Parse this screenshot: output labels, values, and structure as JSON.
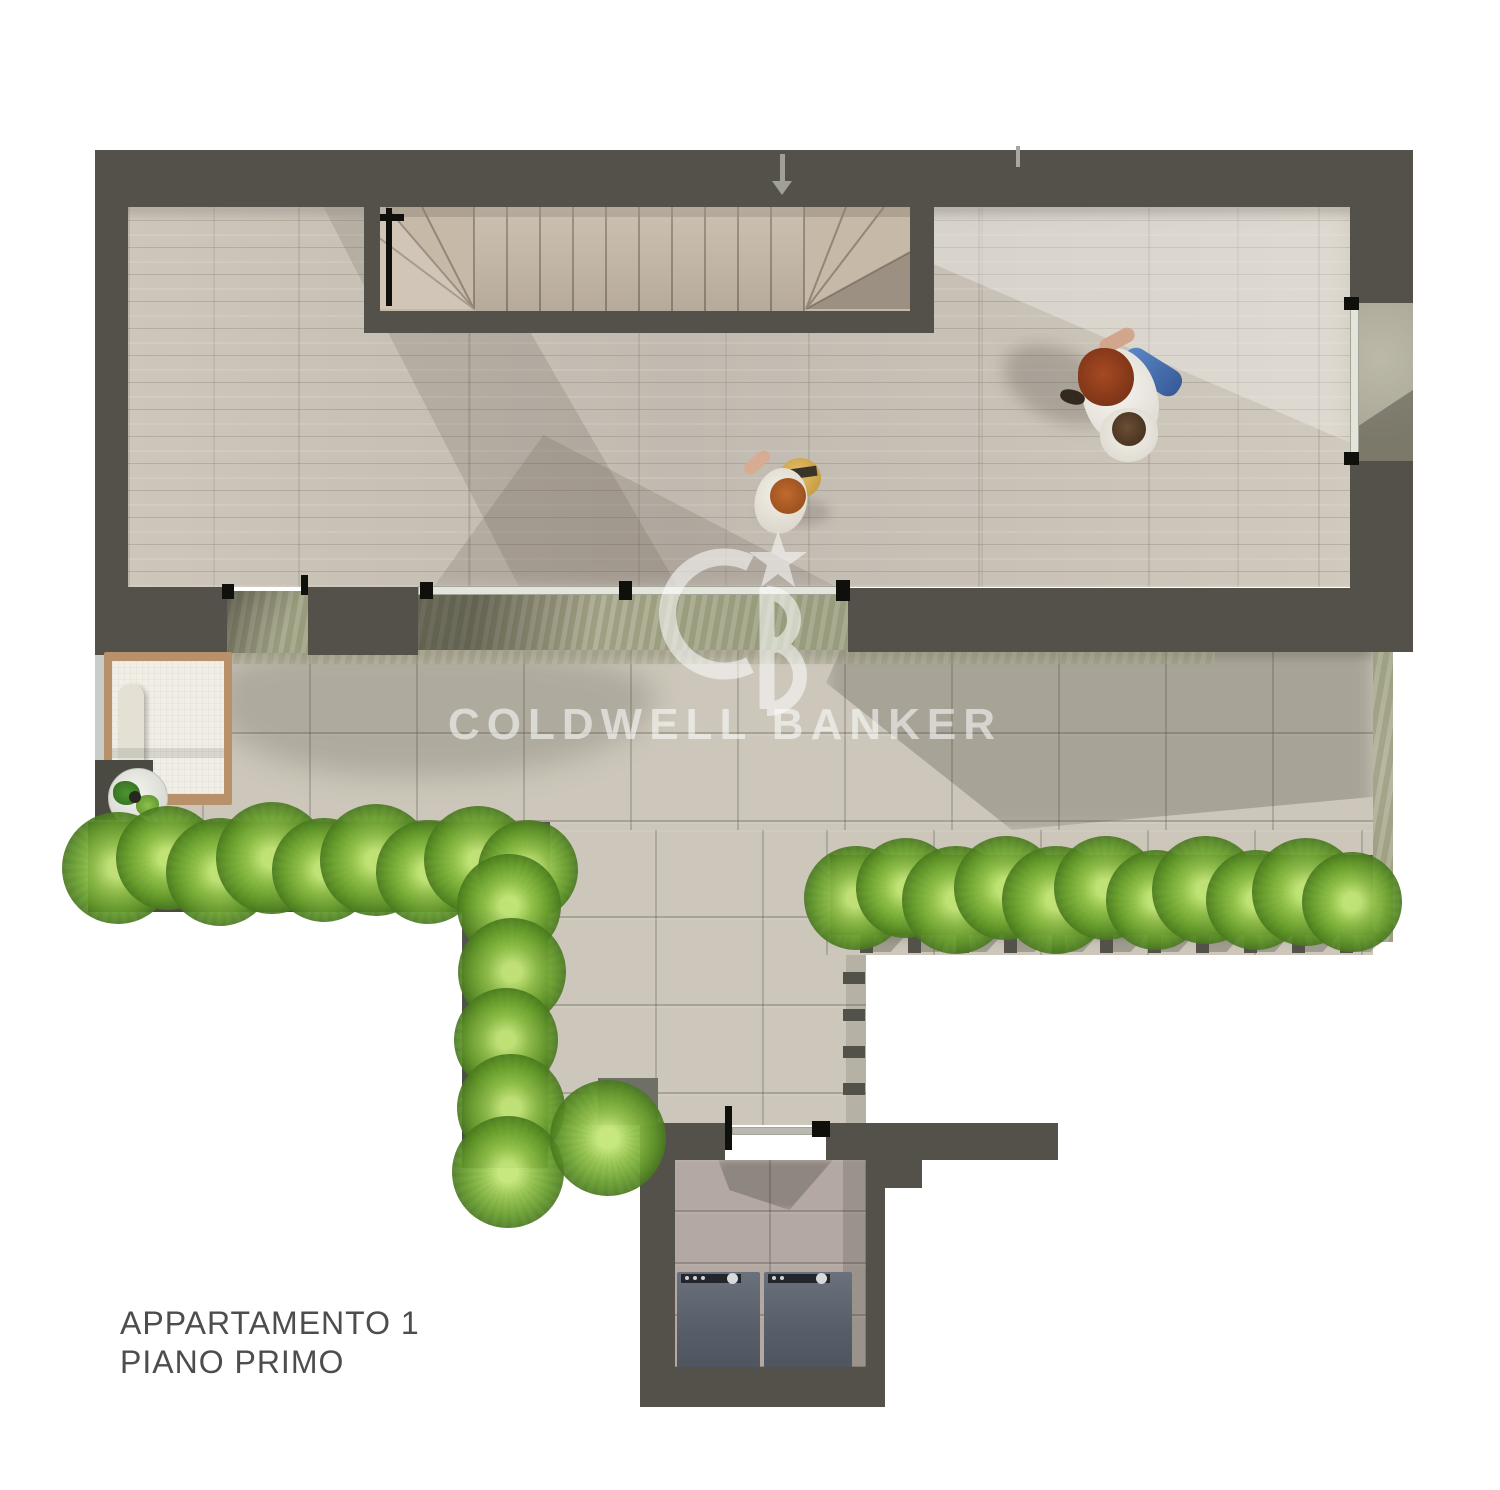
{
  "plan_label": {
    "line1": "APPARTAMENTO 1",
    "line2": "PIANO PRIMO"
  },
  "watermark": {
    "brand": "COLDWELL BANKER",
    "monogram": "CB",
    "star_icon": "star"
  },
  "entry": {
    "arrow_icon": "down-arrow"
  },
  "colors": {
    "background": "#ffffff",
    "wall": "#53514a",
    "wood_floor": "#c8c1b5",
    "stair_tread": "#c6b9a8",
    "terrace_tile": "#ccc7ba",
    "moss_stone": "#a8ab90",
    "laundry_tile": "#b3a9a2",
    "planter": "#4e5148",
    "grass": "#6fa32f",
    "appliance": "#5f6670",
    "glass_door": "#e3e4db",
    "lounge_wood_frame": "#b8906a",
    "lounge_cushion": "#f1eee6",
    "jeans_blue": "#4f7fc0",
    "label_text": "#4e4d4b",
    "watermark_white": "rgba(255,255,255,0.55)",
    "arrow_gray": "#a0a098"
  },
  "counts": {
    "straight_stair_treads": 10,
    "winder_ends": 2,
    "appliances": 2,
    "people": 3,
    "grass_tufts": 26,
    "railing_posts_bottom": 11,
    "railing_posts_side": 4,
    "glass_door_pivots_main": 3
  }
}
